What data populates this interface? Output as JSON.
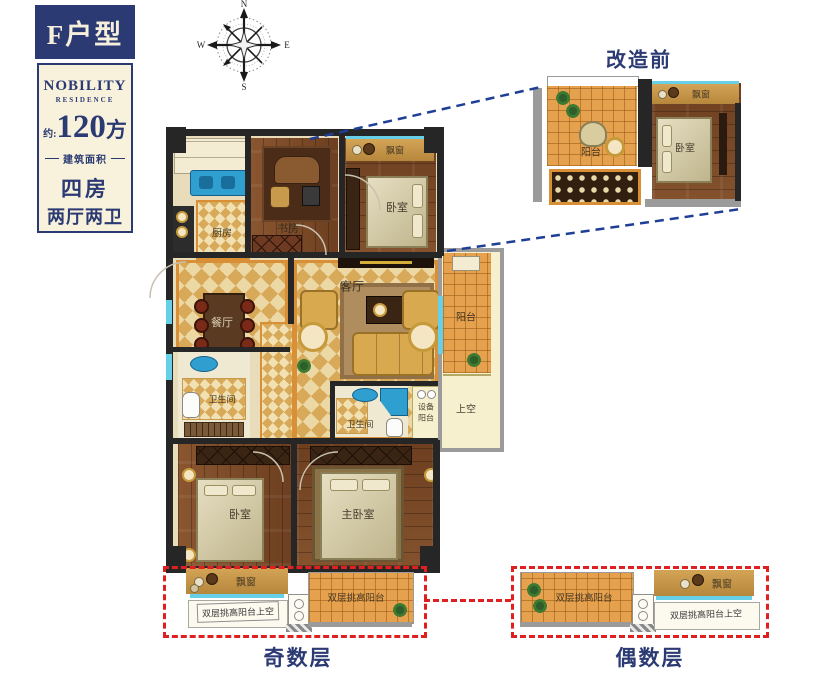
{
  "panel": {
    "unit": "F户型",
    "brand": "NOBILITY",
    "brand_sub": "RESIDENCE",
    "area_prefix": "约:",
    "area_value": "120",
    "area_unit": "方",
    "area_caption": "建筑面积",
    "rooms_line1": "四房",
    "rooms_line2": "两厅两卫"
  },
  "compass": {
    "north": "N",
    "south": "S",
    "east": "E",
    "west": "W"
  },
  "inset": {
    "title": "改造前",
    "balcony": "阳台",
    "bedroom": "卧室",
    "bay_window": "飘窗"
  },
  "plan": {
    "kitchen": "厨房",
    "study": "书房",
    "bedroom_top": "卧室",
    "bay_top": "飘窗",
    "dining": "餐厅",
    "living": "客厅",
    "bath_left": "卫生间",
    "bath_mid": "卫生间",
    "equip_line1": "设备",
    "equip_line2": "阳台",
    "balcony_right": "阳台",
    "void_right": "上空",
    "bedroom_left": "卧室",
    "master_bedroom": "主卧室",
    "bay_bottom": "飘窗"
  },
  "odd_floor": {
    "caption": "奇数层",
    "bay_window": "飘窗",
    "void_label": "双层挑高阳台上空",
    "balcony_label": "双层挑高阳台"
  },
  "even_floor": {
    "caption": "偶数层",
    "bay_window": "飘窗",
    "void_label": "双层挑高阳台上空",
    "balcony_label": "双层挑高阳台"
  },
  "colors": {
    "navy": "#2b3a73",
    "cream_panel": "#f8f2dc",
    "wall_dark": "#262626",
    "wall_gray": "#9b9b9b",
    "wood_floor": "#7a4a28",
    "tile_gold": "#d7a958",
    "balcony_tile": "#e6a14e",
    "window_cyan": "#68cfe8",
    "bay_band": "#cf9a44",
    "void_cream": "#f7f0cf",
    "red_dashed": "#e02020",
    "blue_dashed": "#1e3f96"
  }
}
